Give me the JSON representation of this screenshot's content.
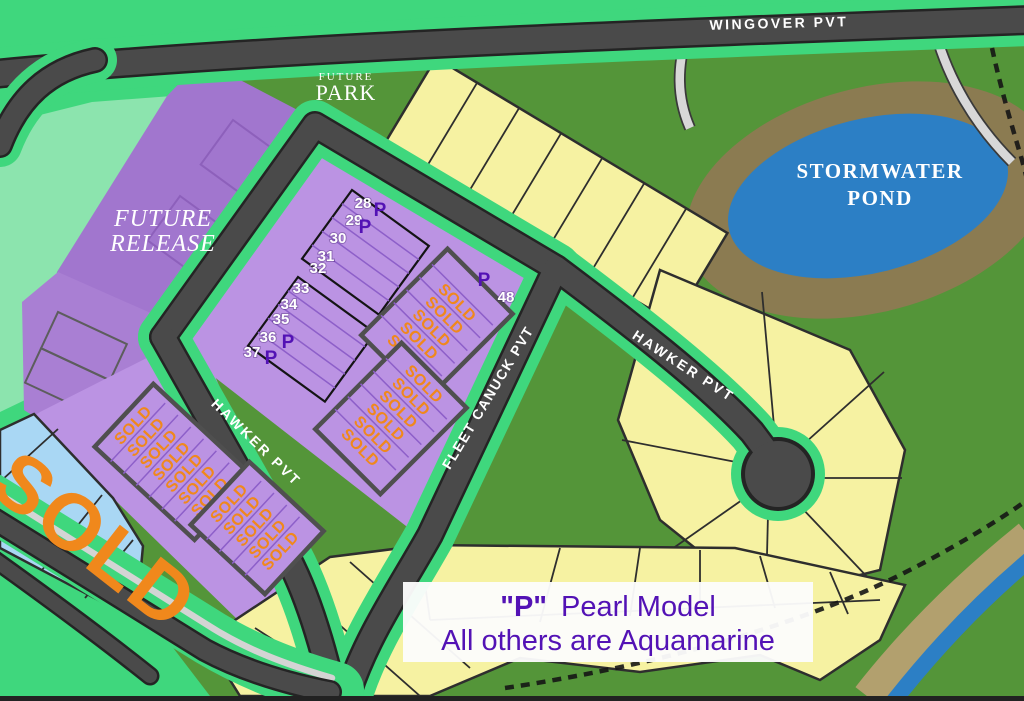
{
  "roads": {
    "wingover": "WINGOVER PVT",
    "hawker_left": "HAWKER PVT",
    "hawker_right": "HAWKER PVT",
    "fleet_canuck": "FLEET CANUCK PVT"
  },
  "areas": {
    "future_release": {
      "line1": "FUTURE",
      "line2": "RELEASE"
    },
    "future_park": {
      "line1": "FUTURE",
      "line2": "PARK"
    },
    "stormwater_pond": {
      "line1": "STORMWATER",
      "line2": "POND"
    }
  },
  "legend": {
    "symbol": "\"P\"",
    "model": "Pearl Model",
    "note": "All others are Aquamarine"
  },
  "markers": {
    "pearl": "P"
  },
  "sold_label": "SOLD",
  "big_sold_text": "SOLD",
  "numbered_lots": [
    {
      "number": "28",
      "pearl": true
    },
    {
      "number": "29",
      "pearl": true
    },
    {
      "number": "30",
      "pearl": false
    },
    {
      "number": "31",
      "pearl": false
    },
    {
      "number": "32",
      "pearl": false
    },
    {
      "number": "33",
      "pearl": false
    },
    {
      "number": "34",
      "pearl": false
    },
    {
      "number": "35",
      "pearl": false
    },
    {
      "number": "36",
      "pearl": true
    },
    {
      "number": "37",
      "pearl": true
    },
    {
      "number": "48",
      "pearl": true
    }
  ],
  "sold_blocks": {
    "hawker_upper": [
      "SOLD",
      "SOLD",
      "SOLD",
      "SOLD",
      "SOLD",
      "SOLD",
      "SOLD"
    ],
    "hawker_lower": [
      "SOLD",
      "SOLD",
      "SOLD",
      "SOLD",
      "SOLD"
    ],
    "fleet_upper": [
      "SOLD",
      "SOLD",
      "SOLD",
      "SOLD",
      "SOLD"
    ],
    "fleet_lower": [
      "SOLD",
      "SOLD",
      "SOLD",
      "SOLD",
      "SOLD",
      "SOLD"
    ]
  },
  "colors": {
    "road": "#4a4a4a",
    "road_verge_green": "#3fd77d",
    "open_space_green": "#549539",
    "meadow_mint": "#8ce4ae",
    "future_release_purple": "#a176ce",
    "lot_purple": "#bb93e3",
    "lot_yellow": "#f6f2a2",
    "lot_blue": "#a9d7f4",
    "pond_blue": "#2c7fc5",
    "pond_bank_olive": "#8b7b51",
    "sold_orange": "#f0881c",
    "pearl_purple": "#5312b5",
    "path_gray": "#d8d8d8",
    "legend_bg": "#fcfcfc"
  }
}
